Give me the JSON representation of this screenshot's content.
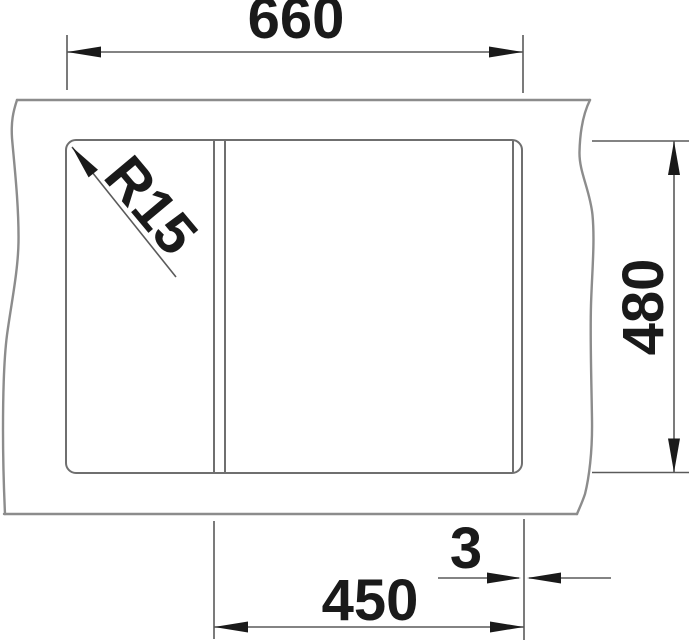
{
  "diagram": {
    "labels": {
      "top_width": "660",
      "right_height": "480",
      "bottom_width": "450",
      "bottom_offset": "3",
      "corner_radius": "R15"
    },
    "colors": {
      "background": "#ffffff",
      "break_line": "#8c8c8c",
      "cutout_line": "#6f6f6f",
      "dimension_line": "#5a5a5a",
      "annotation_text": "#1a1a1a"
    }
  }
}
